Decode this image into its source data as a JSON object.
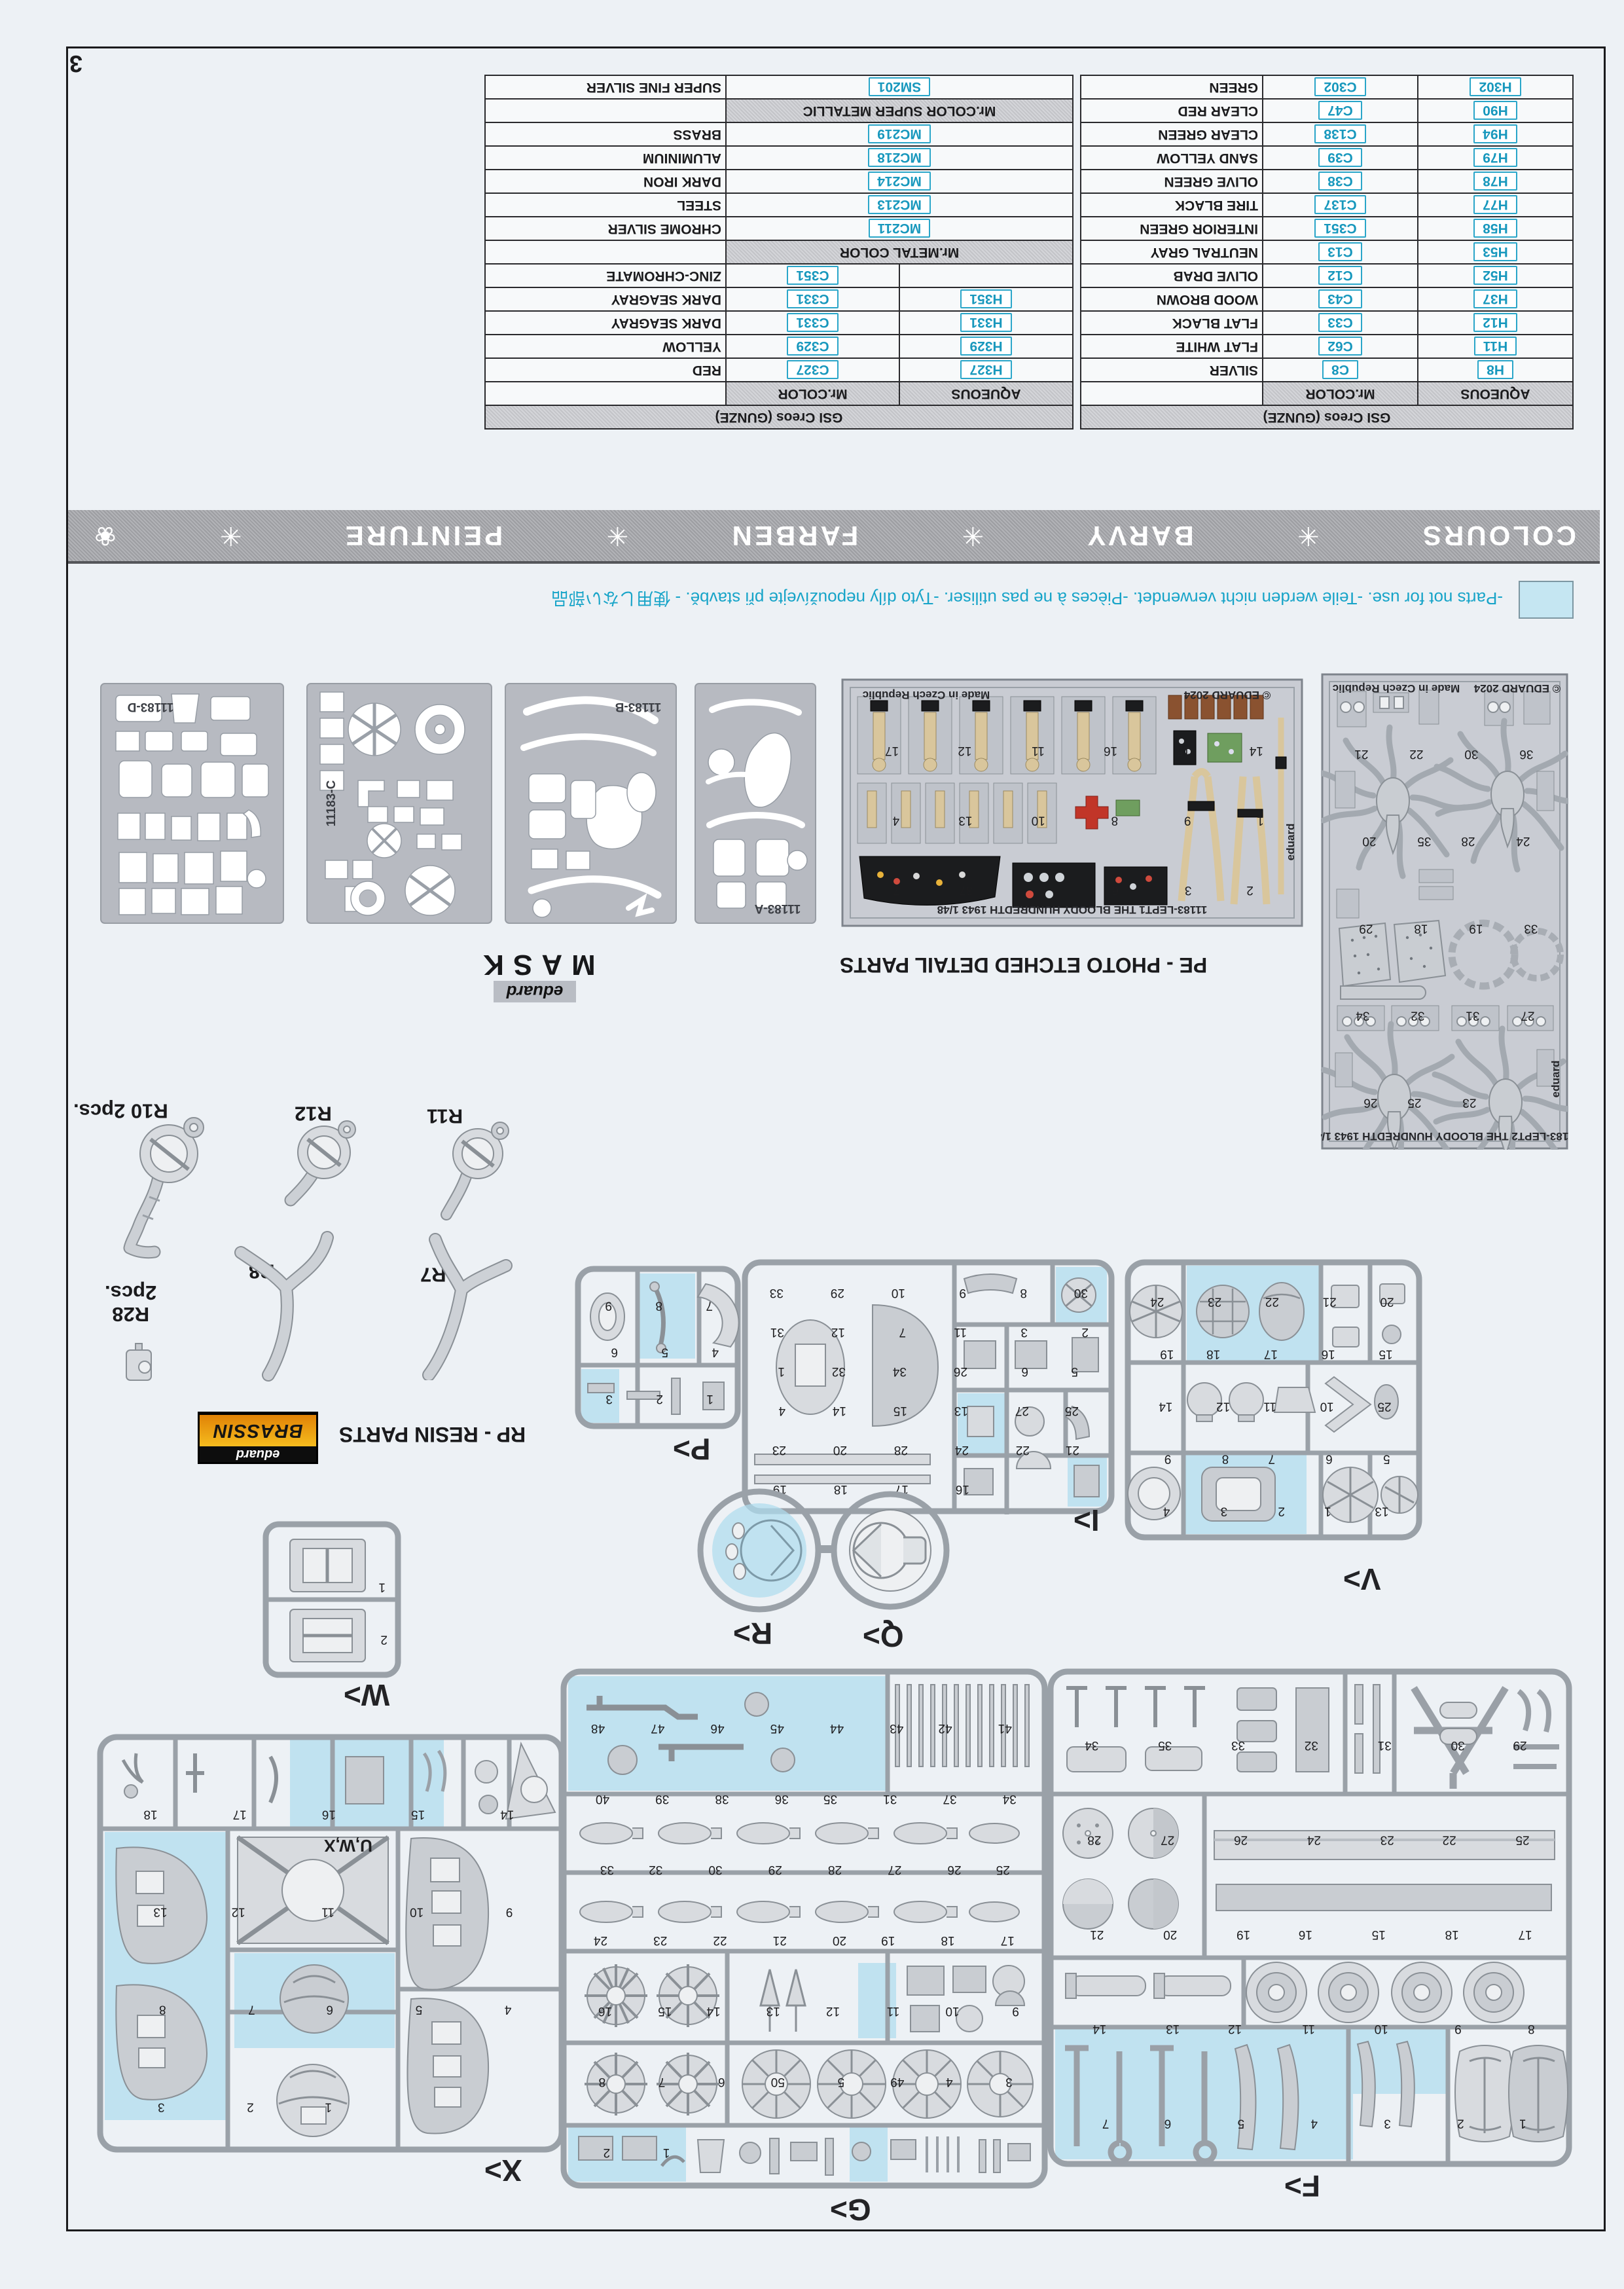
{
  "page": {
    "number": "3"
  },
  "notice": {
    "text": "-Parts not for use.  -Teile werden nicht verwendet.  -Pièces à ne pas utiliser.  -Tyto díly nepoužívejte při stavbě.  -  使用しない部品"
  },
  "banner": {
    "words": [
      "COLOURS",
      "BARVY",
      "FARBEN",
      "PEINTURE"
    ],
    "separator": "✳",
    "ornament": "❀"
  },
  "tables": {
    "metal": {
      "brand": "GSI Creos (GUNZE)",
      "columns": [
        "AQUEOUS",
        "Mr.COLOR"
      ],
      "groups": [
        {
          "header": null,
          "rows": [
            {
              "aqueous": "H327",
              "color": "C327",
              "name": "RED"
            },
            {
              "aqueous": "H329",
              "color": "C329",
              "name": "YELLOW"
            },
            {
              "aqueous": "H331",
              "color": "C331",
              "name": "DARK SEAGRAY"
            },
            {
              "aqueous": "H351",
              "color": "C331",
              "name": "DARK SEAGRAY"
            },
            {
              "aqueous": "",
              "color": "C351",
              "name": "ZINC-CHROMATE"
            }
          ]
        },
        {
          "header": "Mr.METAL COLOR",
          "rows": [
            {
              "code": "MC211",
              "name": "CHROME SILVER"
            },
            {
              "code": "MC213",
              "name": "STEEL"
            },
            {
              "code": "MC214",
              "name": "DARK IRON"
            },
            {
              "code": "MC218",
              "name": "ALUMINIUM"
            },
            {
              "code": "MC219",
              "name": "BRASS"
            }
          ]
        },
        {
          "header": "Mr.COLOR SUPER METALLIC",
          "rows": [
            {
              "code": "SM201",
              "name": "SUPER FINE SILVER"
            }
          ]
        }
      ]
    },
    "aqueous": {
      "brand": "GSI Creos (GUNZE)",
      "columns": [
        "AQUEOUS",
        "Mr.COLOR"
      ],
      "groups": [
        {
          "header": null,
          "rows": [
            {
              "aqueous": "H8",
              "color": "C8",
              "name": "SILVER"
            },
            {
              "aqueous": "H11",
              "color": "C62",
              "name": "FLAT WHITE"
            },
            {
              "aqueous": "H12",
              "color": "C33",
              "name": "FLAT BLACK"
            },
            {
              "aqueous": "H37",
              "color": "C43",
              "name": "WOOD BROWN"
            },
            {
              "aqueous": "H52",
              "color": "C12",
              "name": "OLIVE DRAB"
            },
            {
              "aqueous": "H53",
              "color": "C13",
              "name": "NEUTRAL GRAY"
            },
            {
              "aqueous": "H58",
              "color": "C351",
              "name": "INTERIOR GREEN"
            },
            {
              "aqueous": "H77",
              "color": "C137",
              "name": "TIRE BLACK"
            },
            {
              "aqueous": "H78",
              "color": "C38",
              "name": "OLIVE GREEN"
            },
            {
              "aqueous": "H79",
              "color": "C39",
              "name": "SAND YELLOW"
            },
            {
              "aqueous": "H94",
              "color": "C138",
              "name": "CLEAR GREEN"
            },
            {
              "aqueous": "H90",
              "color": "C47",
              "name": "CLEAR RED"
            },
            {
              "aqueous": "H302",
              "color": "C302",
              "name": "GREEN"
            }
          ]
        }
      ]
    }
  },
  "masks": {
    "brand": "eduard",
    "word": "MASK",
    "sheets": [
      "11183-D",
      "11183-C",
      "11183-B",
      "11183-A"
    ]
  },
  "pe": {
    "caption": "PE - PHOTO ETCHED DETAIL PARTS",
    "frets": [
      {
        "title": "11183-LEPT1  THE BLOODY HUNDREDTH 1943   1/48",
        "copyright": "© EDUARD 2024",
        "made": "Made in Czech Republic",
        "brand": "eduard",
        "part_numbers": [
          "17",
          "12",
          "11",
          "16",
          "15",
          "14",
          "4",
          "13",
          "10",
          "8",
          "9",
          "1",
          "7",
          "37",
          "5",
          "6",
          "3",
          "2"
        ]
      },
      {
        "title": "11183-LEPT2  THE BLOODY HUNDREDTH 1943   1/48",
        "copyright": "© EDUARD 2024",
        "made": "Made in Czech Republic",
        "brand": "eduard",
        "part_numbers": [
          "21",
          "22",
          "30",
          "36",
          "20",
          "35",
          "28",
          "24",
          "29",
          "18",
          "19",
          "33",
          "34",
          "32",
          "31",
          "27",
          "26",
          "25",
          "23"
        ]
      }
    ]
  },
  "resin": {
    "caption": "RP - RESIN PARTS",
    "logo": {
      "brand": "eduard",
      "name": "BRASSIN"
    },
    "parts": [
      {
        "label": "R10 2pcs."
      },
      {
        "label": "R12"
      },
      {
        "label": "R11"
      },
      {
        "label": "R8"
      },
      {
        "label": "R7"
      },
      {
        "label": "R28",
        "qty": "2pcs."
      }
    ]
  },
  "sprues": {
    "F": {
      "label": "F>",
      "not_for_use": [
        3,
        4,
        5,
        6,
        7,
        8
      ],
      "part_numbers": [
        "34",
        "35",
        "33",
        "32",
        "31",
        "30",
        "29",
        "28",
        "27",
        "26",
        "24",
        "23",
        "22",
        "25",
        "21",
        "20",
        "19",
        "16",
        "15",
        "18",
        "17",
        "14",
        "13",
        "12",
        "11",
        "10",
        "9",
        "8",
        "7",
        "6",
        "5",
        "4",
        "3",
        "2",
        "1"
      ]
    },
    "G": {
      "label": "G>",
      "not_for_use": [
        10,
        13,
        24,
        25,
        26,
        37,
        46,
        47,
        48
      ],
      "part_numbers": [
        "48",
        "47",
        "46",
        "45",
        "44",
        "43",
        "42",
        "41",
        "40",
        "39",
        "38",
        "36",
        "35",
        "31",
        "37",
        "34",
        "33",
        "32",
        "30",
        "29",
        "28",
        "27",
        "26",
        "25",
        "24",
        "23",
        "22",
        "21",
        "20",
        "19",
        "18",
        "17",
        "16",
        "15",
        "14",
        "13",
        "12",
        "11",
        "10",
        "9",
        "8",
        "7",
        "6",
        "50",
        "5",
        "49",
        "4",
        "3",
        "2",
        "1"
      ]
    },
    "X": {
      "label": "X>",
      "code": "U,W,X",
      "not_for_use": [
        4,
        5,
        6,
        8,
        12,
        13,
        16,
        17
      ],
      "part_numbers": [
        "18",
        "17",
        "16",
        "15",
        "14",
        "13",
        "12",
        "11",
        "10",
        "9",
        "8",
        "7",
        "6",
        "5",
        "4",
        "3",
        "2",
        "1"
      ]
    },
    "P": {
      "label": "P>",
      "not_for_use": [
        3,
        8
      ],
      "part_numbers": [
        "9",
        "8",
        "7",
        "6",
        "5",
        "4",
        "3",
        "2",
        "1"
      ]
    },
    "I": {
      "label": "I>",
      "not_for_use": [
        2,
        10,
        13,
        19
      ],
      "part_numbers": [
        "33",
        "29",
        "10",
        "9",
        "8",
        "30",
        "31",
        "12",
        "7",
        "11",
        "3",
        "2",
        "1",
        "32",
        "34",
        "26",
        "6",
        "5",
        "4",
        "14",
        "15",
        "13",
        "27",
        "25",
        "23",
        "20",
        "28",
        "24",
        "22",
        "21",
        "19",
        "18",
        "17",
        "16"
      ]
    },
    "V": {
      "label": "V>",
      "not_for_use": [
        5,
        9,
        22,
        23
      ],
      "part_numbers": [
        "24",
        "23",
        "22",
        "21",
        "20",
        "19",
        "18",
        "17",
        "16",
        "15",
        "14",
        "12",
        "11",
        "10",
        "25",
        "9",
        "8",
        "7",
        "6",
        "5",
        "4",
        "3",
        "2",
        "1",
        "13"
      ]
    },
    "W": {
      "label": "W>",
      "not_for_use": [],
      "part_numbers": [
        "1",
        "2"
      ]
    },
    "Q": {
      "label": "Q>"
    },
    "R": {
      "label": "R>",
      "not_for_use": "all"
    }
  }
}
